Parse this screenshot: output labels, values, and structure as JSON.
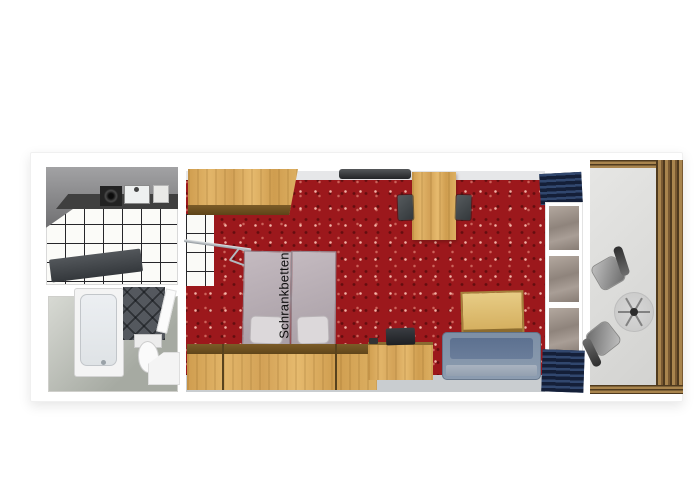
{
  "floorplan": {
    "labels": {
      "wall_beds": "Schrankbetten"
    },
    "rooms": {
      "kitchen": {
        "items": [
          "upper-cabinets",
          "counter",
          "stove",
          "sink",
          "tiled-floor",
          "small-table"
        ]
      },
      "bathroom": {
        "items": [
          "bathtub",
          "dark-tiled-wall",
          "toilet",
          "vanity-sink",
          "door"
        ]
      },
      "living_room": {
        "items": [
          "wardrobe",
          "clothes-rail",
          "wall-bed-left",
          "wall-bed-right",
          "pillows",
          "wall-tv",
          "dining-table",
          "dining-chairs",
          "sideboard",
          "desk",
          "desk-tv",
          "coffee-table",
          "sofa",
          "curtains",
          "window"
        ]
      },
      "balcony": {
        "items": [
          "wood-railing",
          "chair-1",
          "chair-2",
          "round-glass-table"
        ]
      }
    },
    "colors": {
      "carpet_red": "#9c181c",
      "wood_light": "#d9a958",
      "wood_dark": "#6b4e20",
      "bed_gray": "#b9aeb5",
      "pillow_gray": "#dcd8da",
      "sofa_blue": "#8495a9",
      "curtain_navy": "#223252",
      "glass_gray": "#9b9089",
      "tile_dark": "#54585e",
      "floor_gray": "#c9cdd0",
      "rail_brown": "#7a5a32",
      "counter_dark": "#3f3f3f"
    }
  }
}
